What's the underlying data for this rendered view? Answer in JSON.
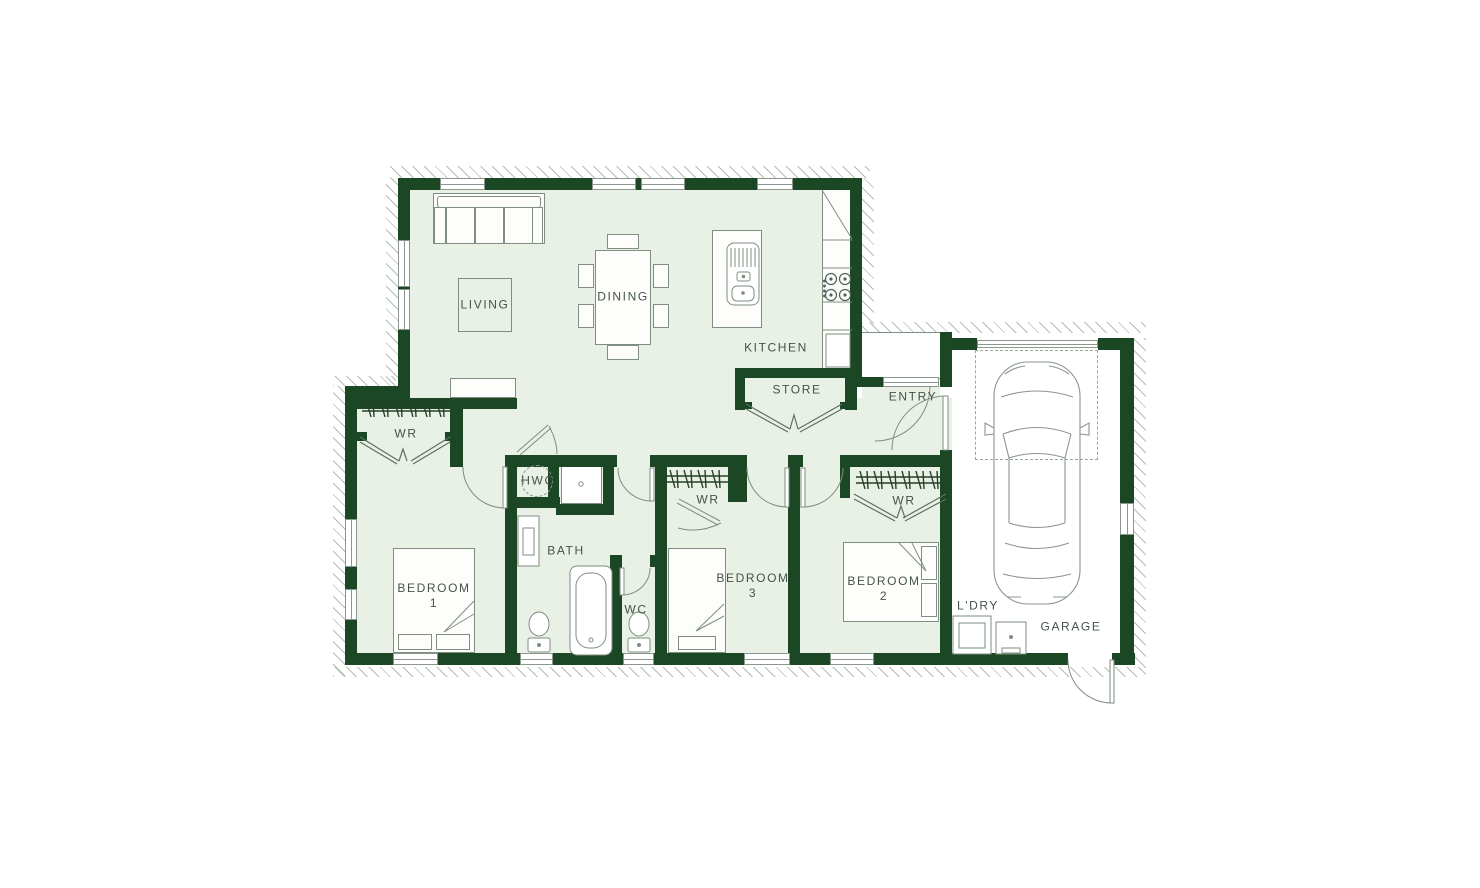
{
  "plan": {
    "colors": {
      "wall": "#1c4724",
      "floor_tint": "#e9f0e6",
      "line": "#7e8e80",
      "text": "#445347"
    },
    "rooms": {
      "living": {
        "label": "LIVING"
      },
      "dining": {
        "label": "DINING"
      },
      "kitchen": {
        "label": "KITCHEN"
      },
      "store": {
        "label": "STORE"
      },
      "entry": {
        "label": "ENTRY"
      },
      "wr1": {
        "label": "WR"
      },
      "wr2": {
        "label": "WR"
      },
      "wr3": {
        "label": "WR"
      },
      "hwc": {
        "label": "HWC"
      },
      "bath": {
        "label": "BATH"
      },
      "wc": {
        "label": "WC"
      },
      "bedroom1": {
        "label": "BEDROOM",
        "number": "1"
      },
      "bedroom2": {
        "label": "BEDROOM",
        "number": "2"
      },
      "bedroom3": {
        "label": "BEDROOM",
        "number": "3"
      },
      "laundry": {
        "label": "L'DRY"
      },
      "garage": {
        "label": "GARAGE"
      }
    }
  }
}
